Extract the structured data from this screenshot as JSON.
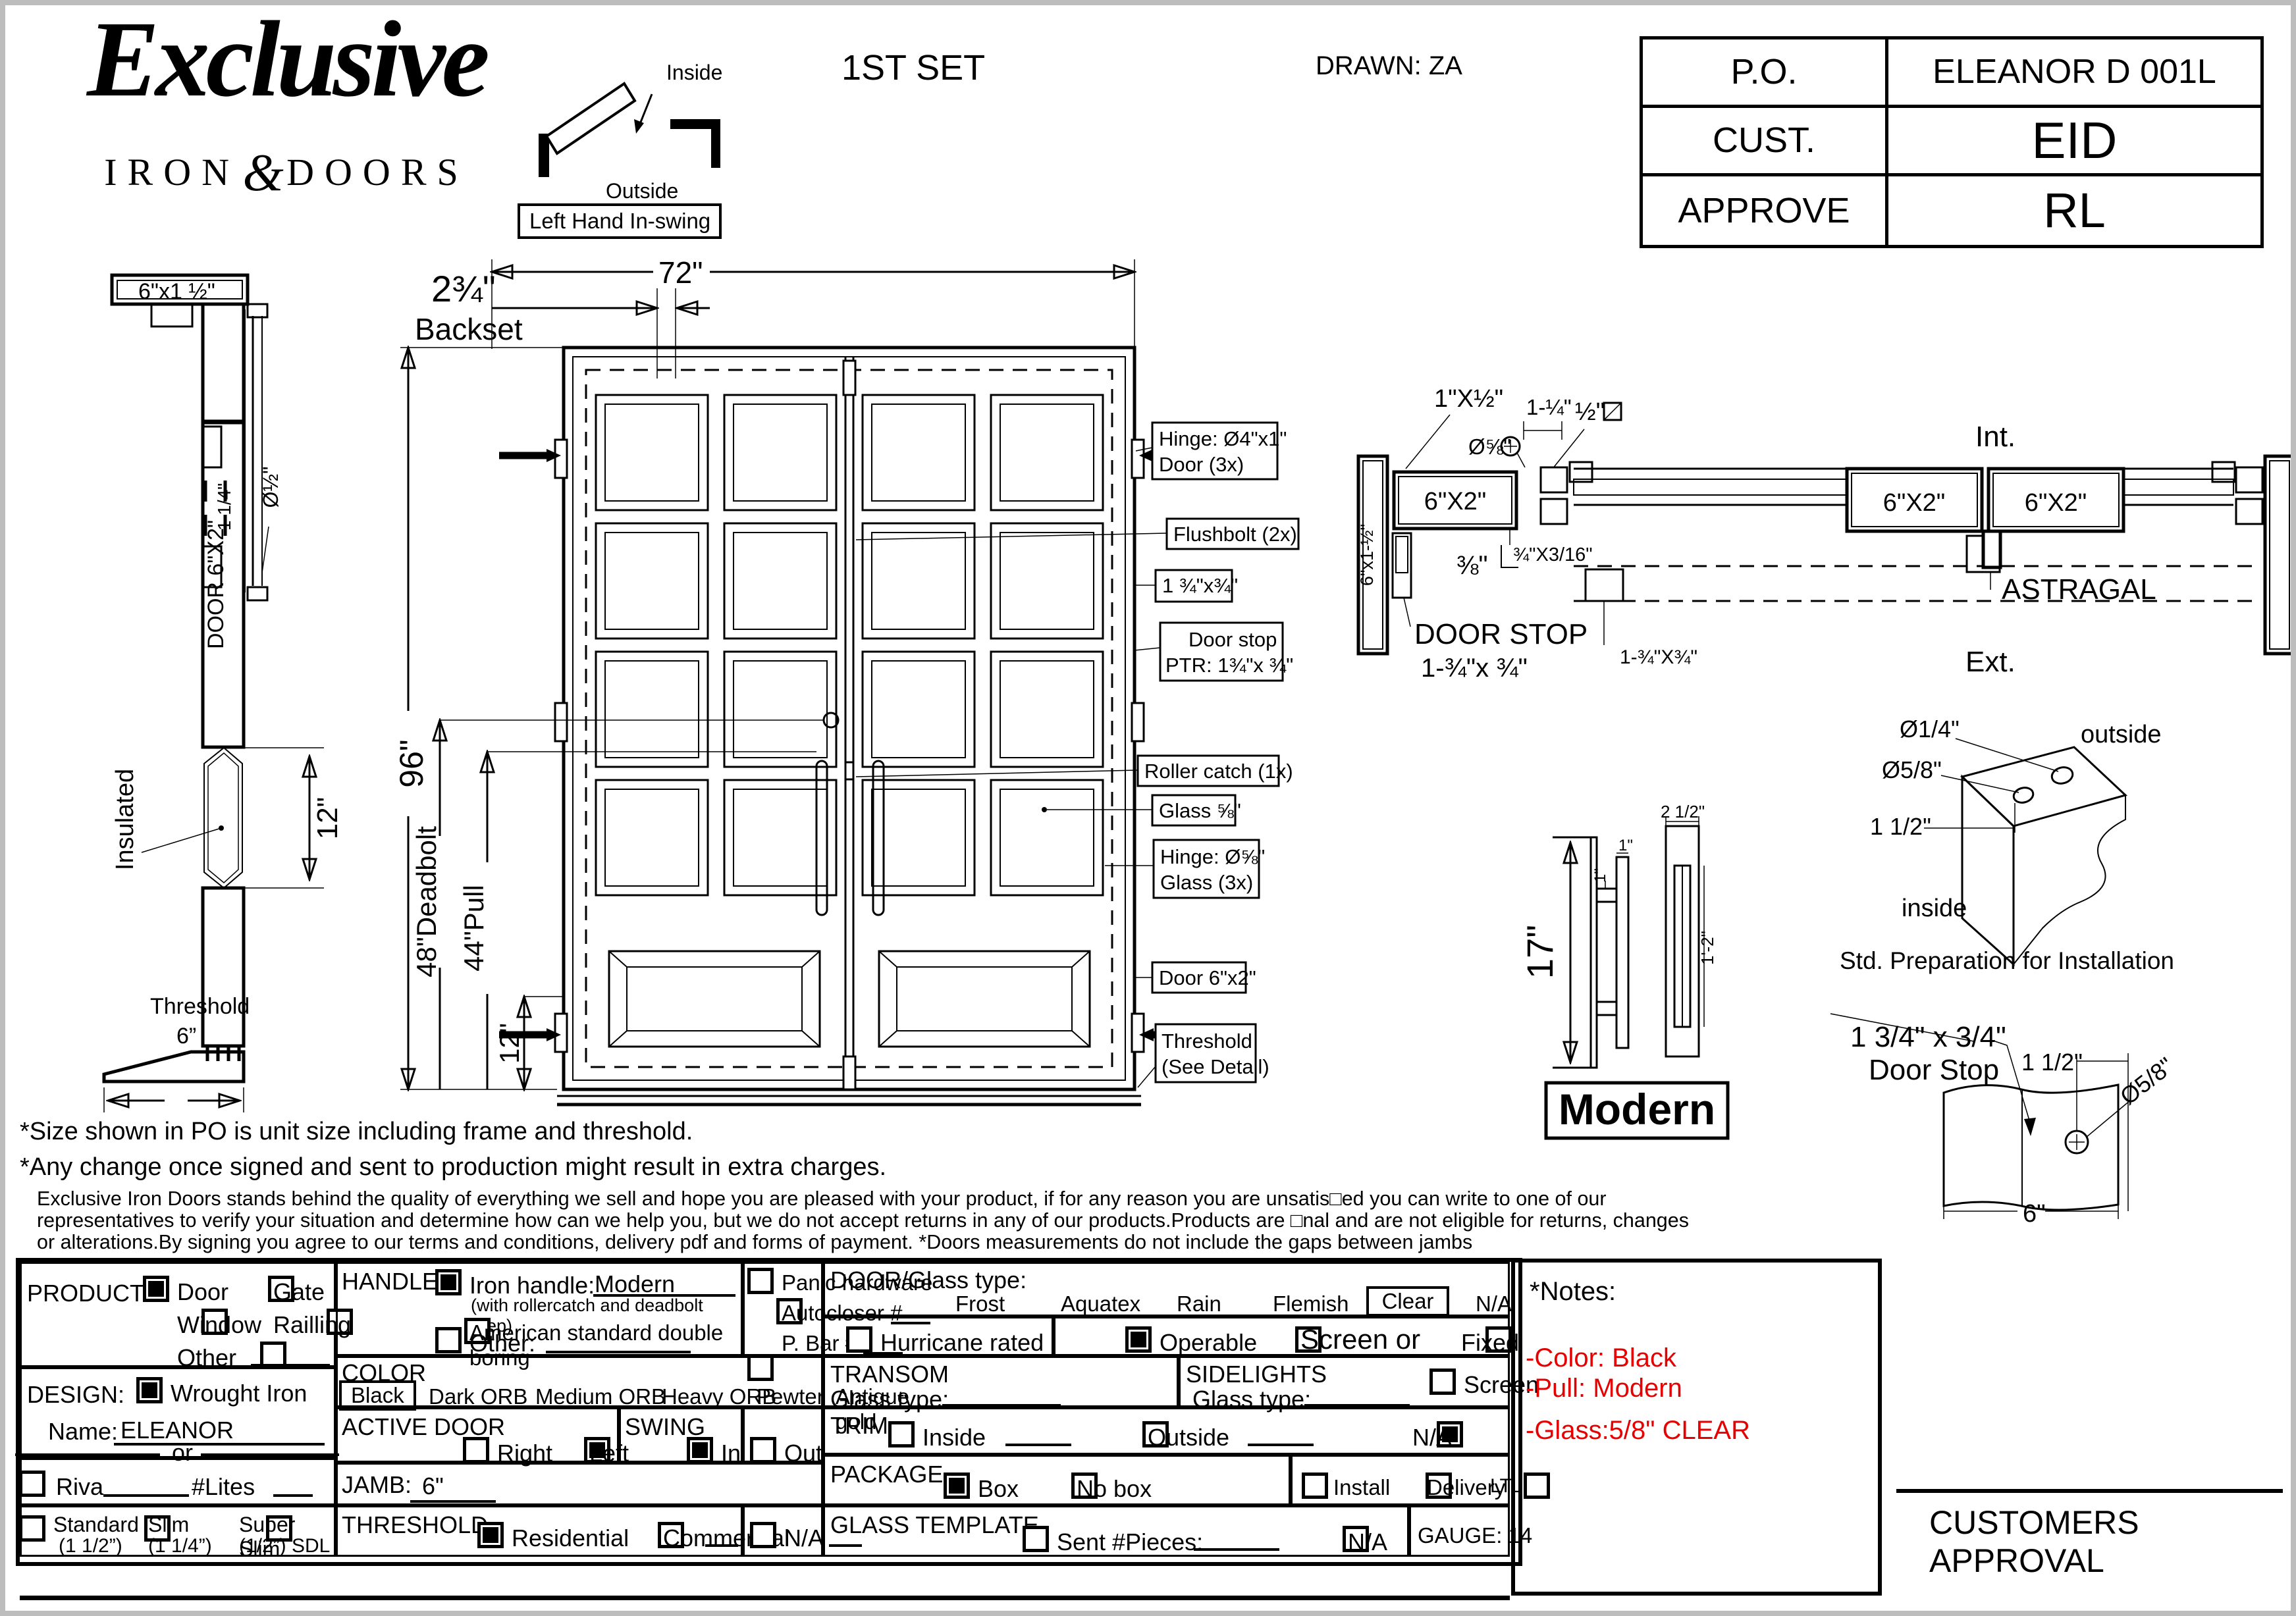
{
  "header": {
    "logo": {
      "word": "Exclusive",
      "iron": "IRON",
      "amp": "&",
      "doors": "DOORS"
    },
    "swing": {
      "inside": "Inside",
      "outside": "Outside",
      "label": "Left Hand In-swing"
    },
    "set_label": "1ST SET",
    "drawn": "DRAWN: ZA"
  },
  "po_table": {
    "rows": [
      {
        "label": "P.O.",
        "value": "ELEANOR D 001L"
      },
      {
        "label": "CUST.",
        "value": "EID"
      },
      {
        "label": "APPROVE",
        "value": "RL"
      }
    ]
  },
  "side_profile": {
    "head": "6\"x1 ½\"",
    "glass_dia": "Ø½\"",
    "one_quarter": "1 1/4\"",
    "door_label": "DOOR 6\"X2\"",
    "insulated": "Insulated",
    "twelve": "12\"",
    "threshold": "Threshold",
    "six": "6”"
  },
  "elevation": {
    "width": "72\"",
    "backset_num": "2¾\"",
    "backset_word": "Backset",
    "height": "96\"",
    "deadbolt": "48\"Deadbolt",
    "pull": "44\"Pull",
    "twelve": "12\"",
    "callouts": {
      "c1a": "Hinge: Ø4\"x1\"",
      "c1b": "Door (3x)",
      "c2": "Flushbolt (2x)",
      "c3": "1 ¾\"x¾\"",
      "c4a": "Door stop",
      "c4b": "PTR: 1¾\"x ¾\"",
      "c5": "Roller catch  (1x)",
      "c6": "Glass ⅝\"",
      "c7a": "Hinge: Ø⅝\"",
      "c7b": "Glass (3x)",
      "c8": "Door 6\"x2\"",
      "c9a": "Threshold",
      "c9b": "(See Detail)"
    }
  },
  "plan": {
    "one_x_half": "1\"X½\"",
    "dia58": "Ø⅝\"",
    "one_quarter": "1-¼\"",
    "half": "½\"",
    "head": "6\"X2\"",
    "jamb": "6\"x1-½\"",
    "three_eighths": "⅜\"",
    "strip": "¾\"X3/16\"",
    "stop_dim": "1-¾\"X¾\"",
    "door_stop_1": "DOOR STOP",
    "door_stop_2": "1-¾\"x ¾\"",
    "leaf_left": "6\"X2\"",
    "leaf_right": "6\"X2\"",
    "int_label": "Int.",
    "ext_label": "Ext.",
    "astragal": "ASTRAGAL"
  },
  "handle_detail": {
    "height": "17\"",
    "one_a": "1\"",
    "one_b": "1\"",
    "width": "2 1/2\"",
    "depth": "1'-2\"",
    "name": "Modern"
  },
  "prep_detail": {
    "small_hole": "Ø1/4\"",
    "big_hole": "Ø5/8\"",
    "offset": "1 1/2\"",
    "outside": "outside",
    "inside": "inside",
    "caption": "Std. Preparation for Installation"
  },
  "stop_detail": {
    "dim": "1 3/4\" x 3/4\"",
    "name": "Door Stop",
    "offset": "1 1/2\"",
    "hole": "Ø5/8\"",
    "width": "6\""
  },
  "notes": {
    "line1": "*Size shown in PO is unit size including frame and threshold.",
    "line2": "*Any change once signed and sent to production might result in extra charges.",
    "para1": "Exclusive Iron Doors stands behind the quality of everything we sell and hope you are pleased with your product, if for any reason you are unsatis□ed you can write to one of our",
    "para2": "representatives to verify your situation and determine how can we help you, but we do not accept returns in any of our products.Products are □nal and are not eligible for returns, changes",
    "para3": "or alterations.By signing you agree to our terms and conditions, delivery pdf and forms of payment. *Doors measurements do not include the gaps between jambs"
  },
  "form": {
    "product": {
      "label": "PRODUCT:",
      "door": "Door",
      "gate": "Gate",
      "window": "Window",
      "railing": "Railling",
      "other": "Other"
    },
    "design": {
      "label": "DESIGN:",
      "wrought": "Wrought Iron",
      "name_label": "Name:",
      "name_value": "ELEANOR",
      "or_label": "or",
      "riva": "Riva",
      "lites": "#Lites",
      "standard": "Standard",
      "standard_sub": "(1 1/2”)",
      "slim": "Slim",
      "slim_sub": "(1 1/4”)",
      "super": "Super Slim",
      "super_sub": "(1/2”) SDL"
    },
    "handle": {
      "label": "HANDLE",
      "iron": "Iron handle:",
      "iron_value": "Modern",
      "iron_sub": "(with rollercatch and deadbolt prep)",
      "american": "American standard double boring",
      "other": "Other:"
    },
    "panic": {
      "panic": "Panic hardware",
      "autocloser": "Autocloser #",
      "pbar": "P. Bar #"
    },
    "color": {
      "label": "COLOR",
      "selected": "Black",
      "black": "Black",
      "dark": "Dark ORB",
      "medium": "Medium ORB",
      "heavy": "Heavy ORB",
      "pewter": "Pewter",
      "antique": "Antique gold"
    },
    "active": {
      "label": "ACTIVE DOOR",
      "right": "Right",
      "left": "Left"
    },
    "swing": {
      "label": "SWING",
      "in_l": "In",
      "out_l": "Out"
    },
    "jamb": {
      "label": "JAMB:",
      "value": "6\""
    },
    "threshold": {
      "label": "THRESHOLD",
      "res": "Residential",
      "com": "Commercial",
      "na": "N/A"
    },
    "glass": {
      "label": "DOOR/Glass type:",
      "frost": "Frost",
      "aquatex": "Aquatex",
      "rain": "Rain",
      "flemish": "Flemish",
      "clear": "Clear",
      "selected": "Clear",
      "na": "N/A"
    },
    "options": {
      "hurricane": "Hurricane rated",
      "operable": "Operable",
      "screen_or": "Screen or",
      "fixed": "Fixed"
    },
    "transom": {
      "label": "TRANSOM",
      "glass": "Glass type:"
    },
    "sidelights": {
      "label": "SIDELIGHTS",
      "glass": "Glass type:",
      "screen": "Screen"
    },
    "trim": {
      "label": "TRIM",
      "inside": "Inside",
      "outside": "Outside",
      "na": "N/A"
    },
    "pack": {
      "label": "PACKAGE",
      "box": "Box",
      "nobox": "No box",
      "install": "Install",
      "delivery": "Delivery",
      "ltl": "LTL"
    },
    "template": {
      "label": "GLASS TEMPLATE",
      "sent": "Sent #Pieces:",
      "na": "N/A"
    },
    "gauge": "GAUGE: 14",
    "checks": {
      "door": true,
      "gate": false,
      "window": false,
      "railing": false,
      "other": false,
      "wrought": true,
      "riva": false,
      "standard": false,
      "slim": false,
      "super": false,
      "iron": true,
      "american": false,
      "handle_other": false,
      "panic": false,
      "autocloser": false,
      "pbar": false,
      "right": false,
      "left": true,
      "in": true,
      "out": false,
      "res": true,
      "com": false,
      "thr_na": false,
      "hurricane": false,
      "operable": true,
      "screen": false,
      "fixed": false,
      "side_screen": false,
      "trim_inside": false,
      "trim_outside": false,
      "trim_na": true,
      "box": true,
      "nobox": false,
      "install": false,
      "delivery": false,
      "ltl": false,
      "sent": false,
      "tpl_na": false
    }
  },
  "notes_panel": {
    "title": "*Notes:",
    "color": "#e60000",
    "items": {
      "a": "-Color: Black",
      "b": "-Pull: Modern",
      "c": "-Glass:5/8\" CLEAR"
    }
  },
  "approval": "CUSTOMERS APPROVAL"
}
